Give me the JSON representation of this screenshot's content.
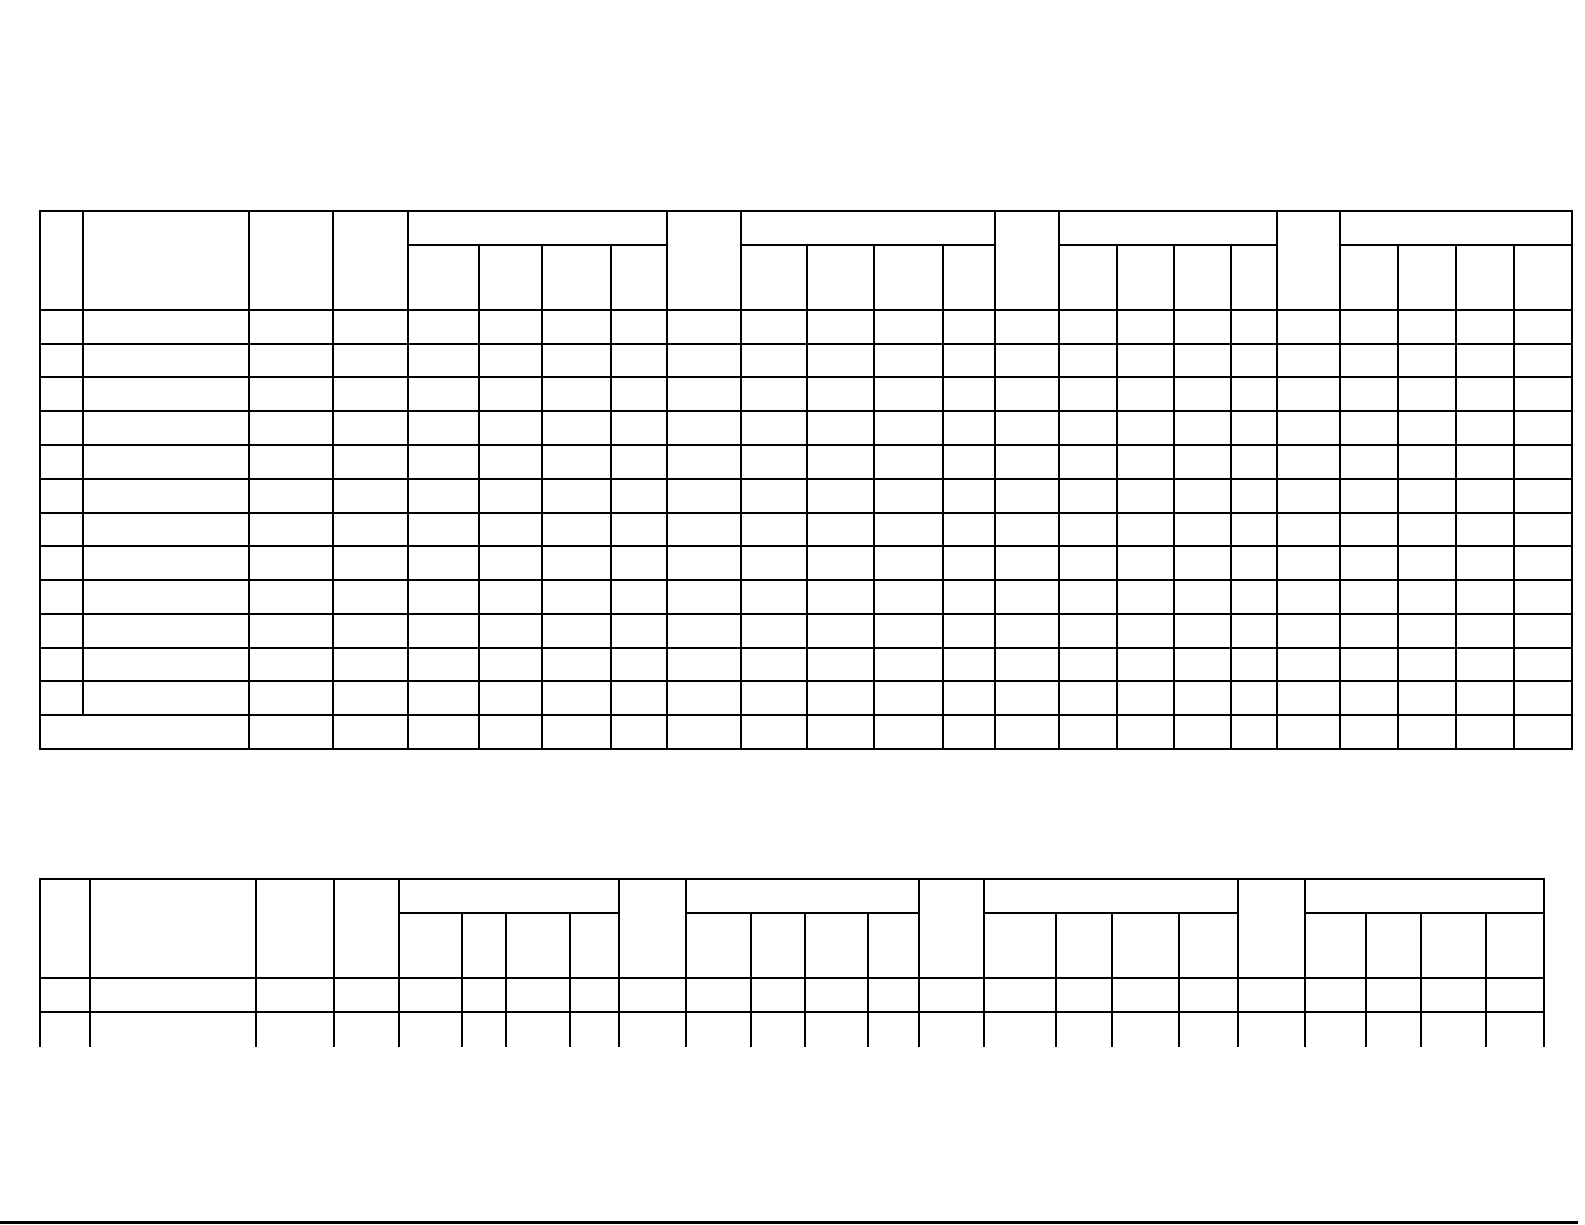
{
  "page": {
    "width": 1585,
    "height": 1225,
    "background_color": "#ffffff",
    "line_color": "#000000",
    "line_thickness": 2,
    "text_content": "",
    "note": "blank form - no visible text, only empty table grids"
  },
  "tables": [
    {
      "name": "blank-form-table-top",
      "description": "empty grid form, 2-tier header with 4 grouped column blocks of 4 subcolumns, 13 empty data rows, last row first two cells merged",
      "h_lines": [
        {
          "y": 211,
          "segments": [
            [
              40,
              1572
            ]
          ]
        },
        {
          "y": 245,
          "segments": [
            [
              408,
              667
            ],
            [
              741,
              995
            ],
            [
              1059,
              1277
            ],
            [
              1340,
              1572
            ]
          ]
        },
        {
          "y": 310,
          "segments": [
            [
              40,
              1572
            ]
          ]
        },
        {
          "y": 344,
          "segments": [
            [
              40,
              1572
            ]
          ]
        },
        {
          "y": 377,
          "segments": [
            [
              40,
              1572
            ]
          ]
        },
        {
          "y": 411,
          "segments": [
            [
              40,
              1572
            ]
          ]
        },
        {
          "y": 445,
          "segments": [
            [
              40,
              1572
            ]
          ]
        },
        {
          "y": 479,
          "segments": [
            [
              40,
              1572
            ]
          ]
        },
        {
          "y": 513,
          "segments": [
            [
              40,
              1572
            ]
          ]
        },
        {
          "y": 546,
          "segments": [
            [
              40,
              1572
            ]
          ]
        },
        {
          "y": 580,
          "segments": [
            [
              40,
              1572
            ]
          ]
        },
        {
          "y": 614,
          "segments": [
            [
              40,
              1572
            ]
          ]
        },
        {
          "y": 648,
          "segments": [
            [
              40,
              1572
            ]
          ]
        },
        {
          "y": 681,
          "segments": [
            [
              40,
              1572
            ]
          ]
        },
        {
          "y": 715,
          "segments": [
            [
              40,
              1572
            ]
          ]
        },
        {
          "y": 749,
          "segments": [
            [
              40,
              1572
            ]
          ]
        }
      ],
      "v_lines": [
        {
          "x": 40,
          "y1": 211,
          "y2": 749
        },
        {
          "x": 83,
          "y1": 211,
          "y2": 715
        },
        {
          "x": 249,
          "y1": 211,
          "y2": 749
        },
        {
          "x": 333,
          "y1": 211,
          "y2": 749
        },
        {
          "x": 408,
          "y1": 211,
          "y2": 749
        },
        {
          "x": 479,
          "y1": 245,
          "y2": 749
        },
        {
          "x": 542,
          "y1": 245,
          "y2": 749
        },
        {
          "x": 611,
          "y1": 245,
          "y2": 749
        },
        {
          "x": 667,
          "y1": 211,
          "y2": 749
        },
        {
          "x": 741,
          "y1": 211,
          "y2": 749
        },
        {
          "x": 807,
          "y1": 245,
          "y2": 749
        },
        {
          "x": 874,
          "y1": 245,
          "y2": 749
        },
        {
          "x": 943,
          "y1": 245,
          "y2": 749
        },
        {
          "x": 995,
          "y1": 211,
          "y2": 749
        },
        {
          "x": 1059,
          "y1": 211,
          "y2": 749
        },
        {
          "x": 1117,
          "y1": 245,
          "y2": 749
        },
        {
          "x": 1174,
          "y1": 245,
          "y2": 749
        },
        {
          "x": 1231,
          "y1": 245,
          "y2": 749
        },
        {
          "x": 1277,
          "y1": 211,
          "y2": 749
        },
        {
          "x": 1340,
          "y1": 211,
          "y2": 749
        },
        {
          "x": 1398,
          "y1": 245,
          "y2": 749
        },
        {
          "x": 1456,
          "y1": 245,
          "y2": 749
        },
        {
          "x": 1514,
          "y1": 245,
          "y2": 749
        },
        {
          "x": 1572,
          "y1": 211,
          "y2": 749
        }
      ]
    },
    {
      "name": "blank-form-table-bottom-truncated",
      "description": "same schema as top table, one empty data row then cut off mid-row at bottom of visible area (no bottom border)",
      "h_lines": [
        {
          "y": 879,
          "segments": [
            [
              40,
              1544
            ]
          ]
        },
        {
          "y": 913,
          "segments": [
            [
              399,
              619
            ],
            [
              686,
              919
            ],
            [
              984,
              1238
            ],
            [
              1305,
              1544
            ]
          ]
        },
        {
          "y": 978,
          "segments": [
            [
              40,
              1544
            ]
          ]
        },
        {
          "y": 1012,
          "segments": [
            [
              40,
              1544
            ]
          ]
        }
      ],
      "v_lines": [
        {
          "x": 40,
          "y1": 879,
          "y2": 1046
        },
        {
          "x": 90,
          "y1": 879,
          "y2": 1046
        },
        {
          "x": 256,
          "y1": 879,
          "y2": 1046
        },
        {
          "x": 334,
          "y1": 879,
          "y2": 1046
        },
        {
          "x": 399,
          "y1": 879,
          "y2": 1046
        },
        {
          "x": 462,
          "y1": 913,
          "y2": 1046
        },
        {
          "x": 506,
          "y1": 913,
          "y2": 1046
        },
        {
          "x": 570,
          "y1": 913,
          "y2": 1046
        },
        {
          "x": 619,
          "y1": 879,
          "y2": 1046
        },
        {
          "x": 686,
          "y1": 879,
          "y2": 1046
        },
        {
          "x": 751,
          "y1": 913,
          "y2": 1046
        },
        {
          "x": 805,
          "y1": 913,
          "y2": 1046
        },
        {
          "x": 868,
          "y1": 913,
          "y2": 1046
        },
        {
          "x": 919,
          "y1": 879,
          "y2": 1046
        },
        {
          "x": 984,
          "y1": 879,
          "y2": 1046
        },
        {
          "x": 1056,
          "y1": 913,
          "y2": 1046
        },
        {
          "x": 1112,
          "y1": 913,
          "y2": 1046
        },
        {
          "x": 1179,
          "y1": 913,
          "y2": 1046
        },
        {
          "x": 1238,
          "y1": 879,
          "y2": 1046
        },
        {
          "x": 1305,
          "y1": 879,
          "y2": 1046
        },
        {
          "x": 1366,
          "y1": 913,
          "y2": 1046
        },
        {
          "x": 1421,
          "y1": 913,
          "y2": 1046
        },
        {
          "x": 1486,
          "y1": 913,
          "y2": 1046
        },
        {
          "x": 1544,
          "y1": 879,
          "y2": 1046
        }
      ]
    }
  ],
  "bottom_rule": {
    "y": 1221,
    "x1": 0,
    "x2": 1578,
    "thickness": 3,
    "color": "#000000"
  }
}
